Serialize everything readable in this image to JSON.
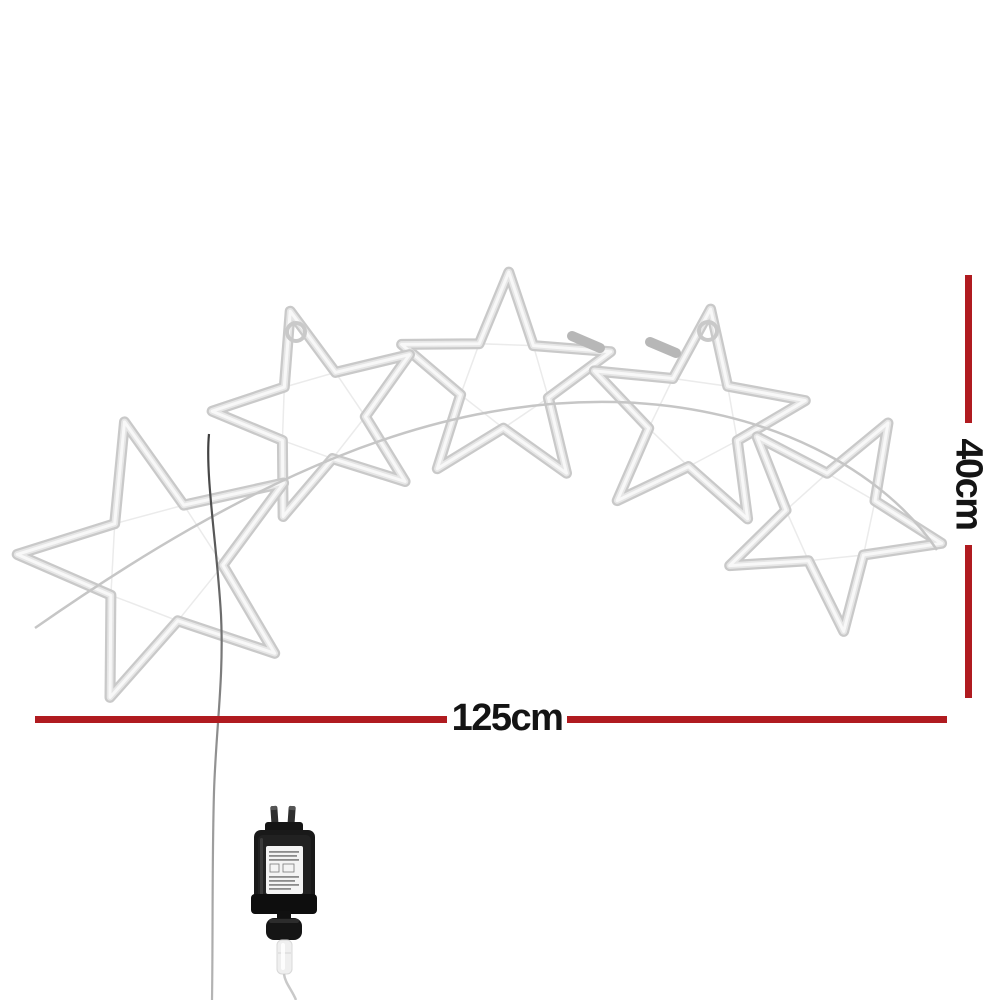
{
  "dimensions": {
    "width_label": "125cm",
    "height_label": "40cm"
  },
  "scene": {
    "star_count": 5,
    "description": "Five star rope-light silhouettes linked along a curved support wire, with a hanging power cord and an AU-plug power adapter below"
  },
  "colors": {
    "background": "#ffffff",
    "dimension_line": "#b01b20",
    "label_text": "#141414",
    "tube": "#c9c9c9",
    "tube_mid": "#e6e6e6",
    "tube_highlight": "#f8f8f8",
    "tube_brace": "#ebebeb",
    "tube_sleeve": "#b7b7b7",
    "support_wire": "#c6c6c6",
    "cord_dark": "#3c3c3c",
    "cord_light": "#b5b5b5",
    "adapter_body": "#191919",
    "adapter_dark": "#0e0e0e",
    "adapter_label": "#f4f4f4",
    "adapter_connector": "#efefef",
    "adapter_cord": "#c9c9c9"
  }
}
